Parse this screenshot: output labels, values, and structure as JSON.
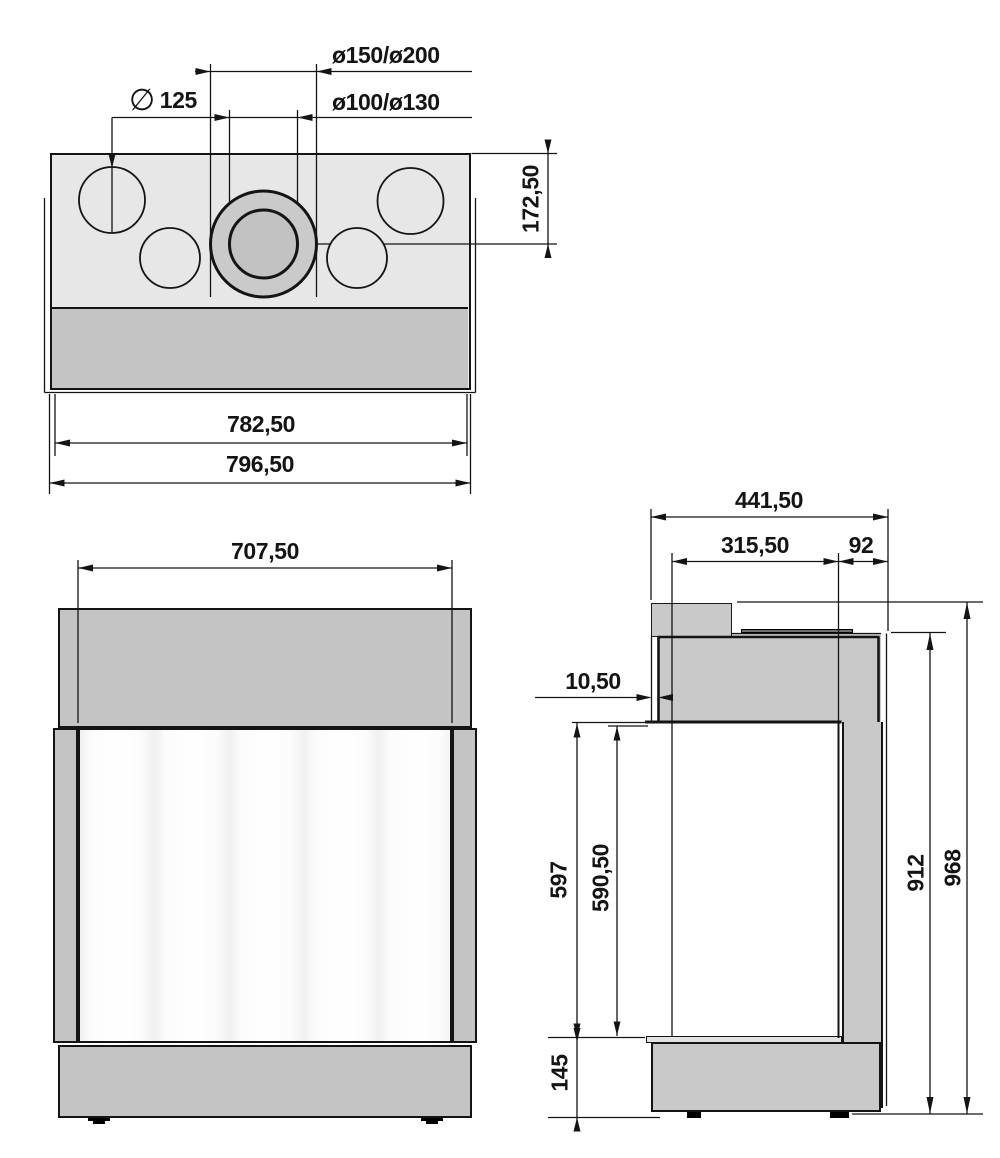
{
  "top_view": {
    "flue_diameter": "ø150/ø200",
    "air_diameter": "ø100/ø130",
    "hole_symbol": "∅",
    "hole_diameter": "125",
    "flue_center_offset": "172,50",
    "body_width": "782,50",
    "total_width": "796,50"
  },
  "front_view": {
    "glass_width": "707,50"
  },
  "side_view": {
    "total_depth": "441,50",
    "glass_depth": "315,50",
    "rear_depth": "92",
    "glass_inset": "10,50",
    "opening_height": "597",
    "glass_height": "590,50",
    "base_height": "145",
    "rear_height": "912",
    "total_height": "968"
  },
  "colors": {
    "outline": "#141414",
    "top_surface": "#e7e7e7",
    "panel_gray": "#c4c4c4",
    "side_gray": "#c9c9c9",
    "flue_ring": "#cacaca",
    "flue_inner": "#c2c2c2",
    "insert_plate": "#6f6f6f",
    "glass": "#fcfcfc"
  }
}
